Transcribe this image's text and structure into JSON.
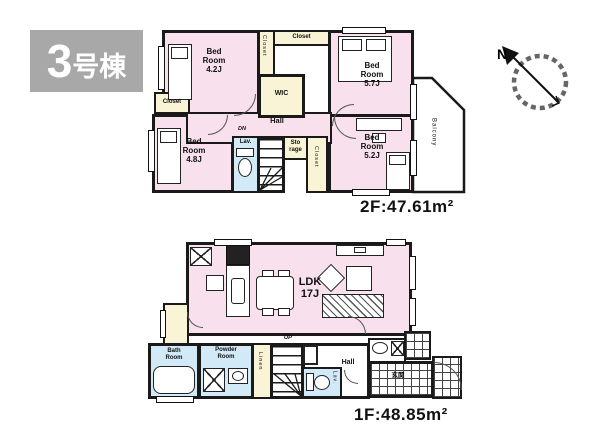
{
  "badge": {
    "number": "3",
    "suffix": "号棟"
  },
  "compass": {
    "north": "N"
  },
  "colors": {
    "wall": "#1a1a1a",
    "room_pink": "#f8e1ec",
    "closet_cream": "#f9f4d5",
    "wet_area_blue": "#d2eaf7",
    "badge_gray": "#a8a8a8"
  },
  "f2": {
    "area": "2F:47.61m²",
    "rooms": {
      "nw": "Bed\nRoom\n4.2J",
      "ne": "Bed\nRoom\n5.7J",
      "sw": "Bed\nRoom\n4.8J",
      "se": "Bed\nRoom\n5.2J",
      "wic": "WIC",
      "closet_v": "Closet",
      "closet_h": "Closet",
      "closet_sw": "Closet",
      "closet_stairs": "Closet",
      "storage": "Sto\nrage",
      "hall": "Hall",
      "dn": "DN",
      "lav": "Lav.",
      "balcony": "Balcony"
    }
  },
  "f1": {
    "area": "1F:48.85m²",
    "rooms": {
      "ldk": "LDK\n17J",
      "bath": "Bath\nRoom",
      "powder": "Powder\nRoom",
      "linen": "Linen",
      "up": "UP",
      "hall": "Hall",
      "lav": "Lav.",
      "entrance": "玄関"
    }
  }
}
